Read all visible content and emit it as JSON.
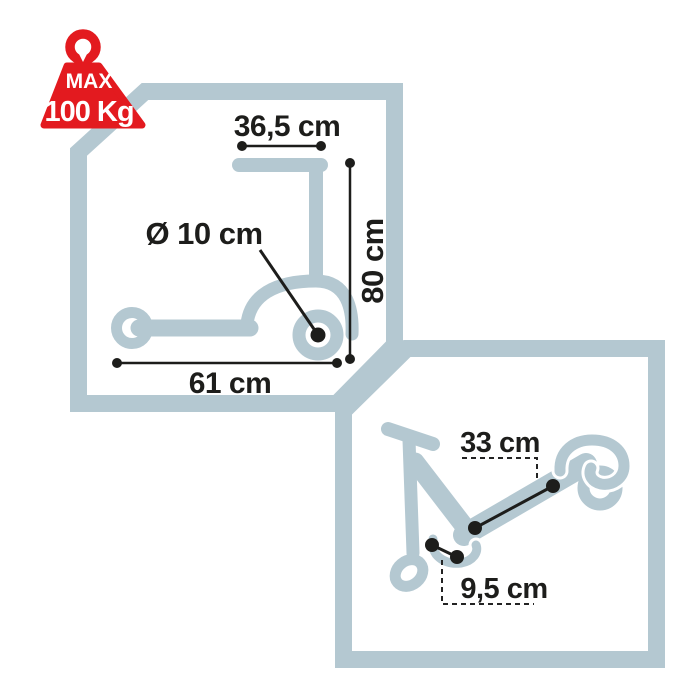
{
  "badge": {
    "max_label": "MAX",
    "weight_label": "100 Kg",
    "meaning": "maximum user weight"
  },
  "panels": {
    "unfolded": {
      "handlebar_width": "36,5 cm",
      "height": "80 cm",
      "wheel_diameter": "Ø 10 cm",
      "length": "61 cm"
    },
    "folded": {
      "deck_length": "33 cm",
      "deck_width": "9,5 cm"
    }
  },
  "colors": {
    "accent_red": "#e31a1f",
    "outline_blue_gray": "#b4c8d1",
    "ink": "#1d1d1b",
    "background": "#ffffff"
  }
}
